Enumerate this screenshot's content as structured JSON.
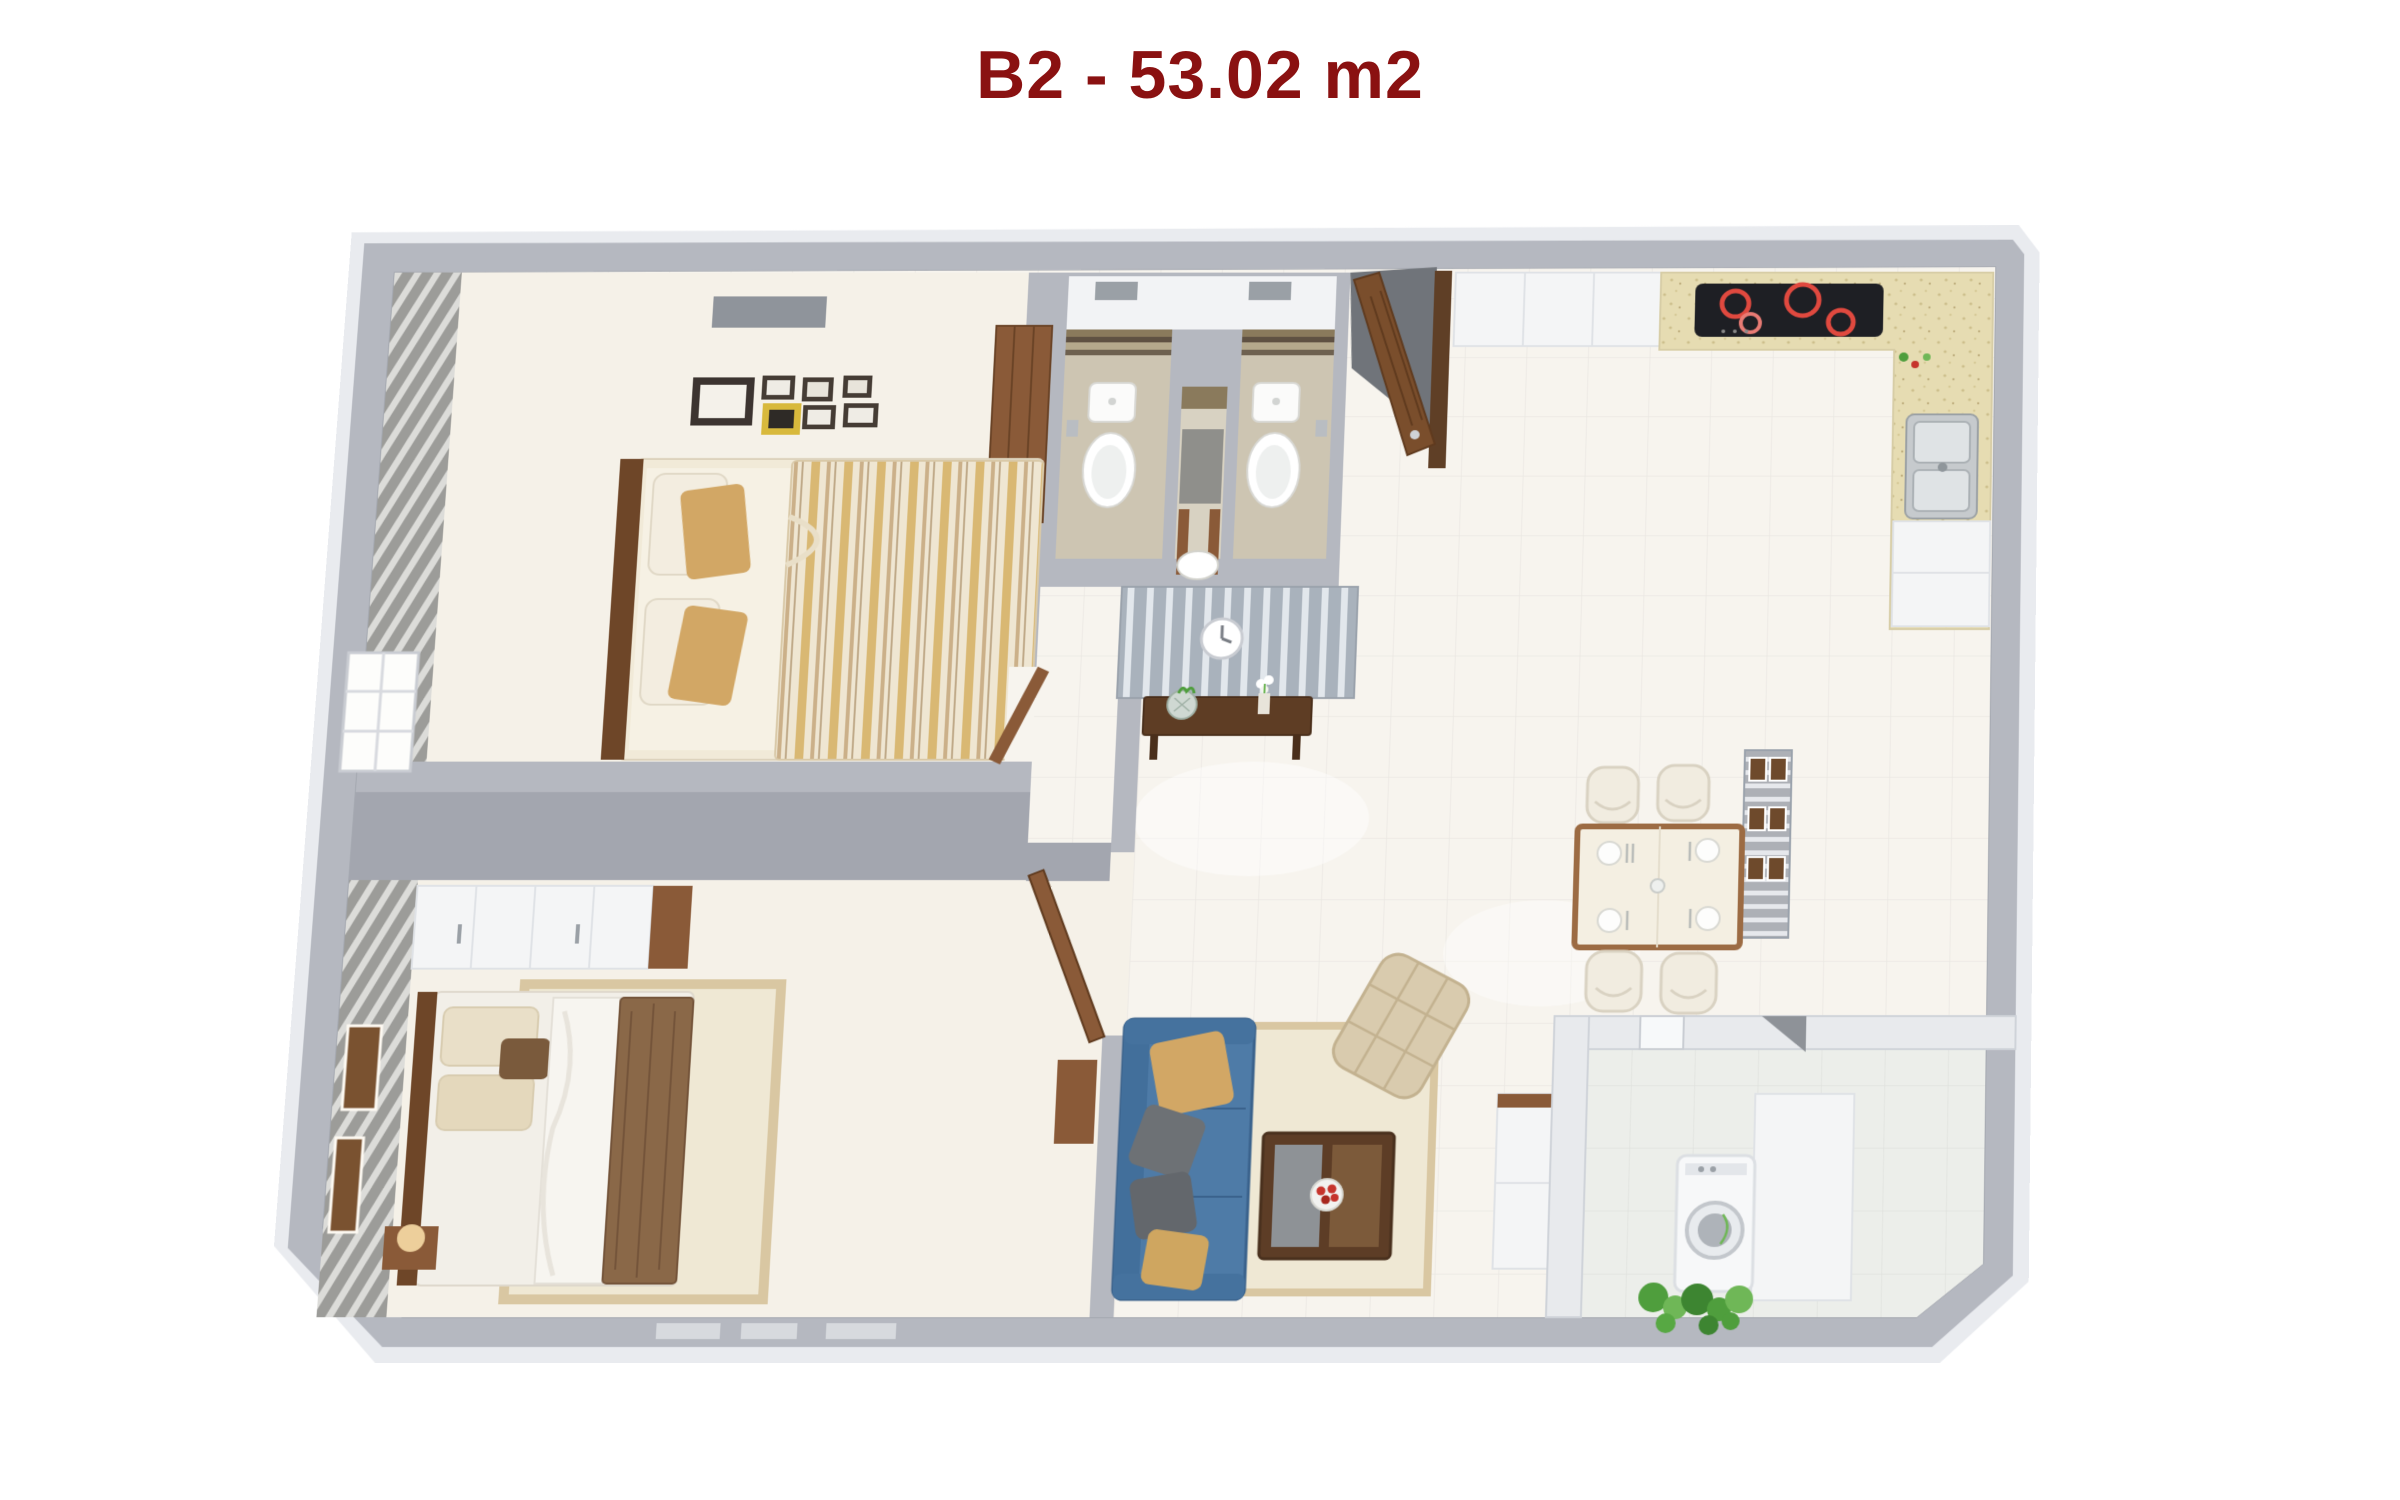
{
  "title": "B2 - 53.02 m2",
  "plan": {
    "unit_code": "B2",
    "area_label": "53.02 m2"
  },
  "colors": {
    "title": "#8a1111",
    "wall": "#b5b8c0",
    "wallDark": "#a3a6af",
    "halo": "#e9ebef",
    "floor": "#f7f4ee",
    "floorWarm": "#f5f1e8",
    "bathFloor": "#cdc5b2",
    "tileBand": "#7b6a50",
    "wood": "#8a5a38",
    "woodDark": "#6e4628",
    "sofa": "#4e7ba7",
    "sofaDark": "#3a628c",
    "pillowTan": "#d2a765",
    "pillowGray": "#6d7175",
    "duvetTan": "#d9b873",
    "duvetCream": "#efe6d2",
    "blanketBrown": "#8a6848",
    "rug": "#efe8d4",
    "rugBorder": "#d9c7a2",
    "armchair": "#d9cbae",
    "counter": "#e6dcb2",
    "cooktop": "#1e1f24",
    "burnerRed": "#e0493f",
    "steel": "#c6cacd",
    "plant": "#4f9e3d",
    "plantLight": "#6fb757",
    "balconyWall": "#e8eaed",
    "stripeBlueA": "#a9b2bc",
    "stripeBlueB": "#e2e7ec",
    "stripeWarmA": "#9c9c99",
    "stripeWarmB": "#dcdcd9",
    "fruitRed": "#c6342c"
  }
}
